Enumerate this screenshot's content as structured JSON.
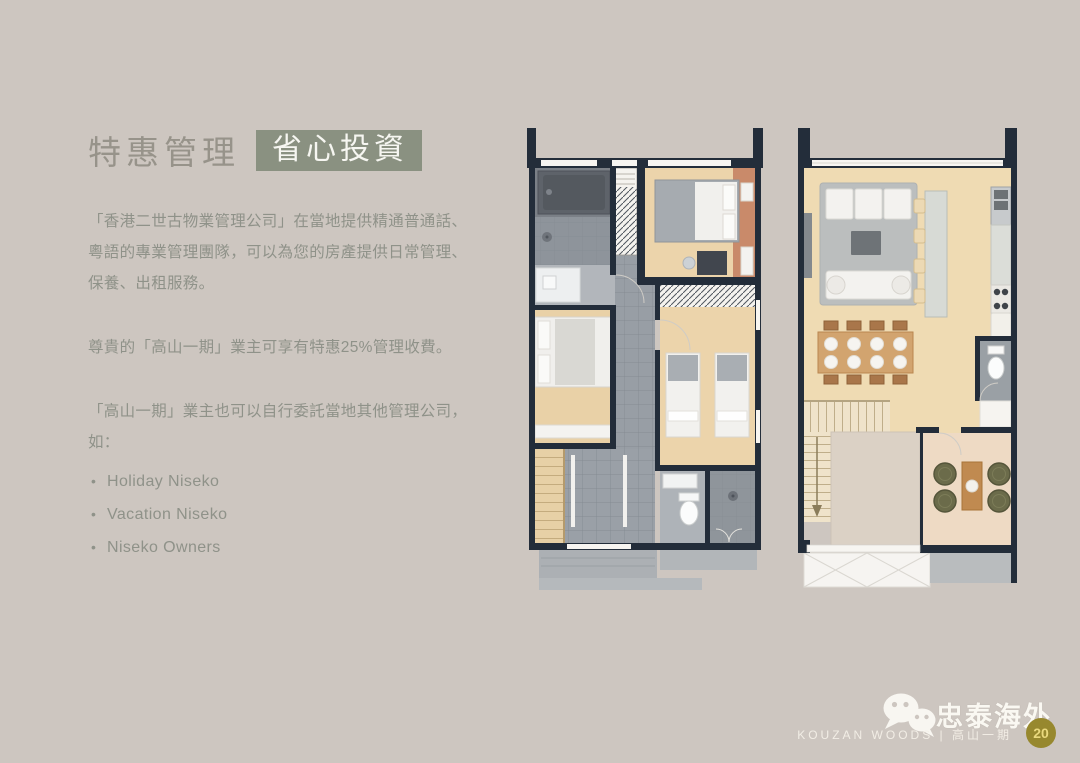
{
  "colors": {
    "page_background": "#cdc6c0",
    "title_gray": "#97938a",
    "badge_green": "#8a9181",
    "body_text": "#8f9289",
    "floorplan_wall_navy": "#232d3a",
    "wood_floor": "#ecd4ab",
    "terracotta_accent": "#c98a6a",
    "footer_text_white": "#faf8f2",
    "page_badge_gold": "#97882e"
  },
  "content": {
    "title": "特惠管理",
    "title_badge": "省心投資",
    "paragraph_1": "「香港二世古物業管理公司」在當地提供精通普通話、粵語的專業管理團隊，可以為您的房產提供日常管理、保養、出租服務。",
    "paragraph_2": "尊貴的「高山一期」業主可享有特惠25%管理收費。",
    "paragraph_3": "「高山一期」業主也可以自行委託當地其他管理公司，如：",
    "bullets": [
      "Holiday Niseko",
      "Vacation Niseko",
      "Niseko Owners"
    ]
  },
  "floorplans": {
    "left": "floor-plan-level-1",
    "right": "floor-plan-level-2"
  },
  "icons": {
    "wechat": "wechat-logo-icon"
  },
  "footer": {
    "brand": "忠泰海外",
    "caption": "KOUZAN WOODS | 高山一期",
    "page_number": "20"
  }
}
